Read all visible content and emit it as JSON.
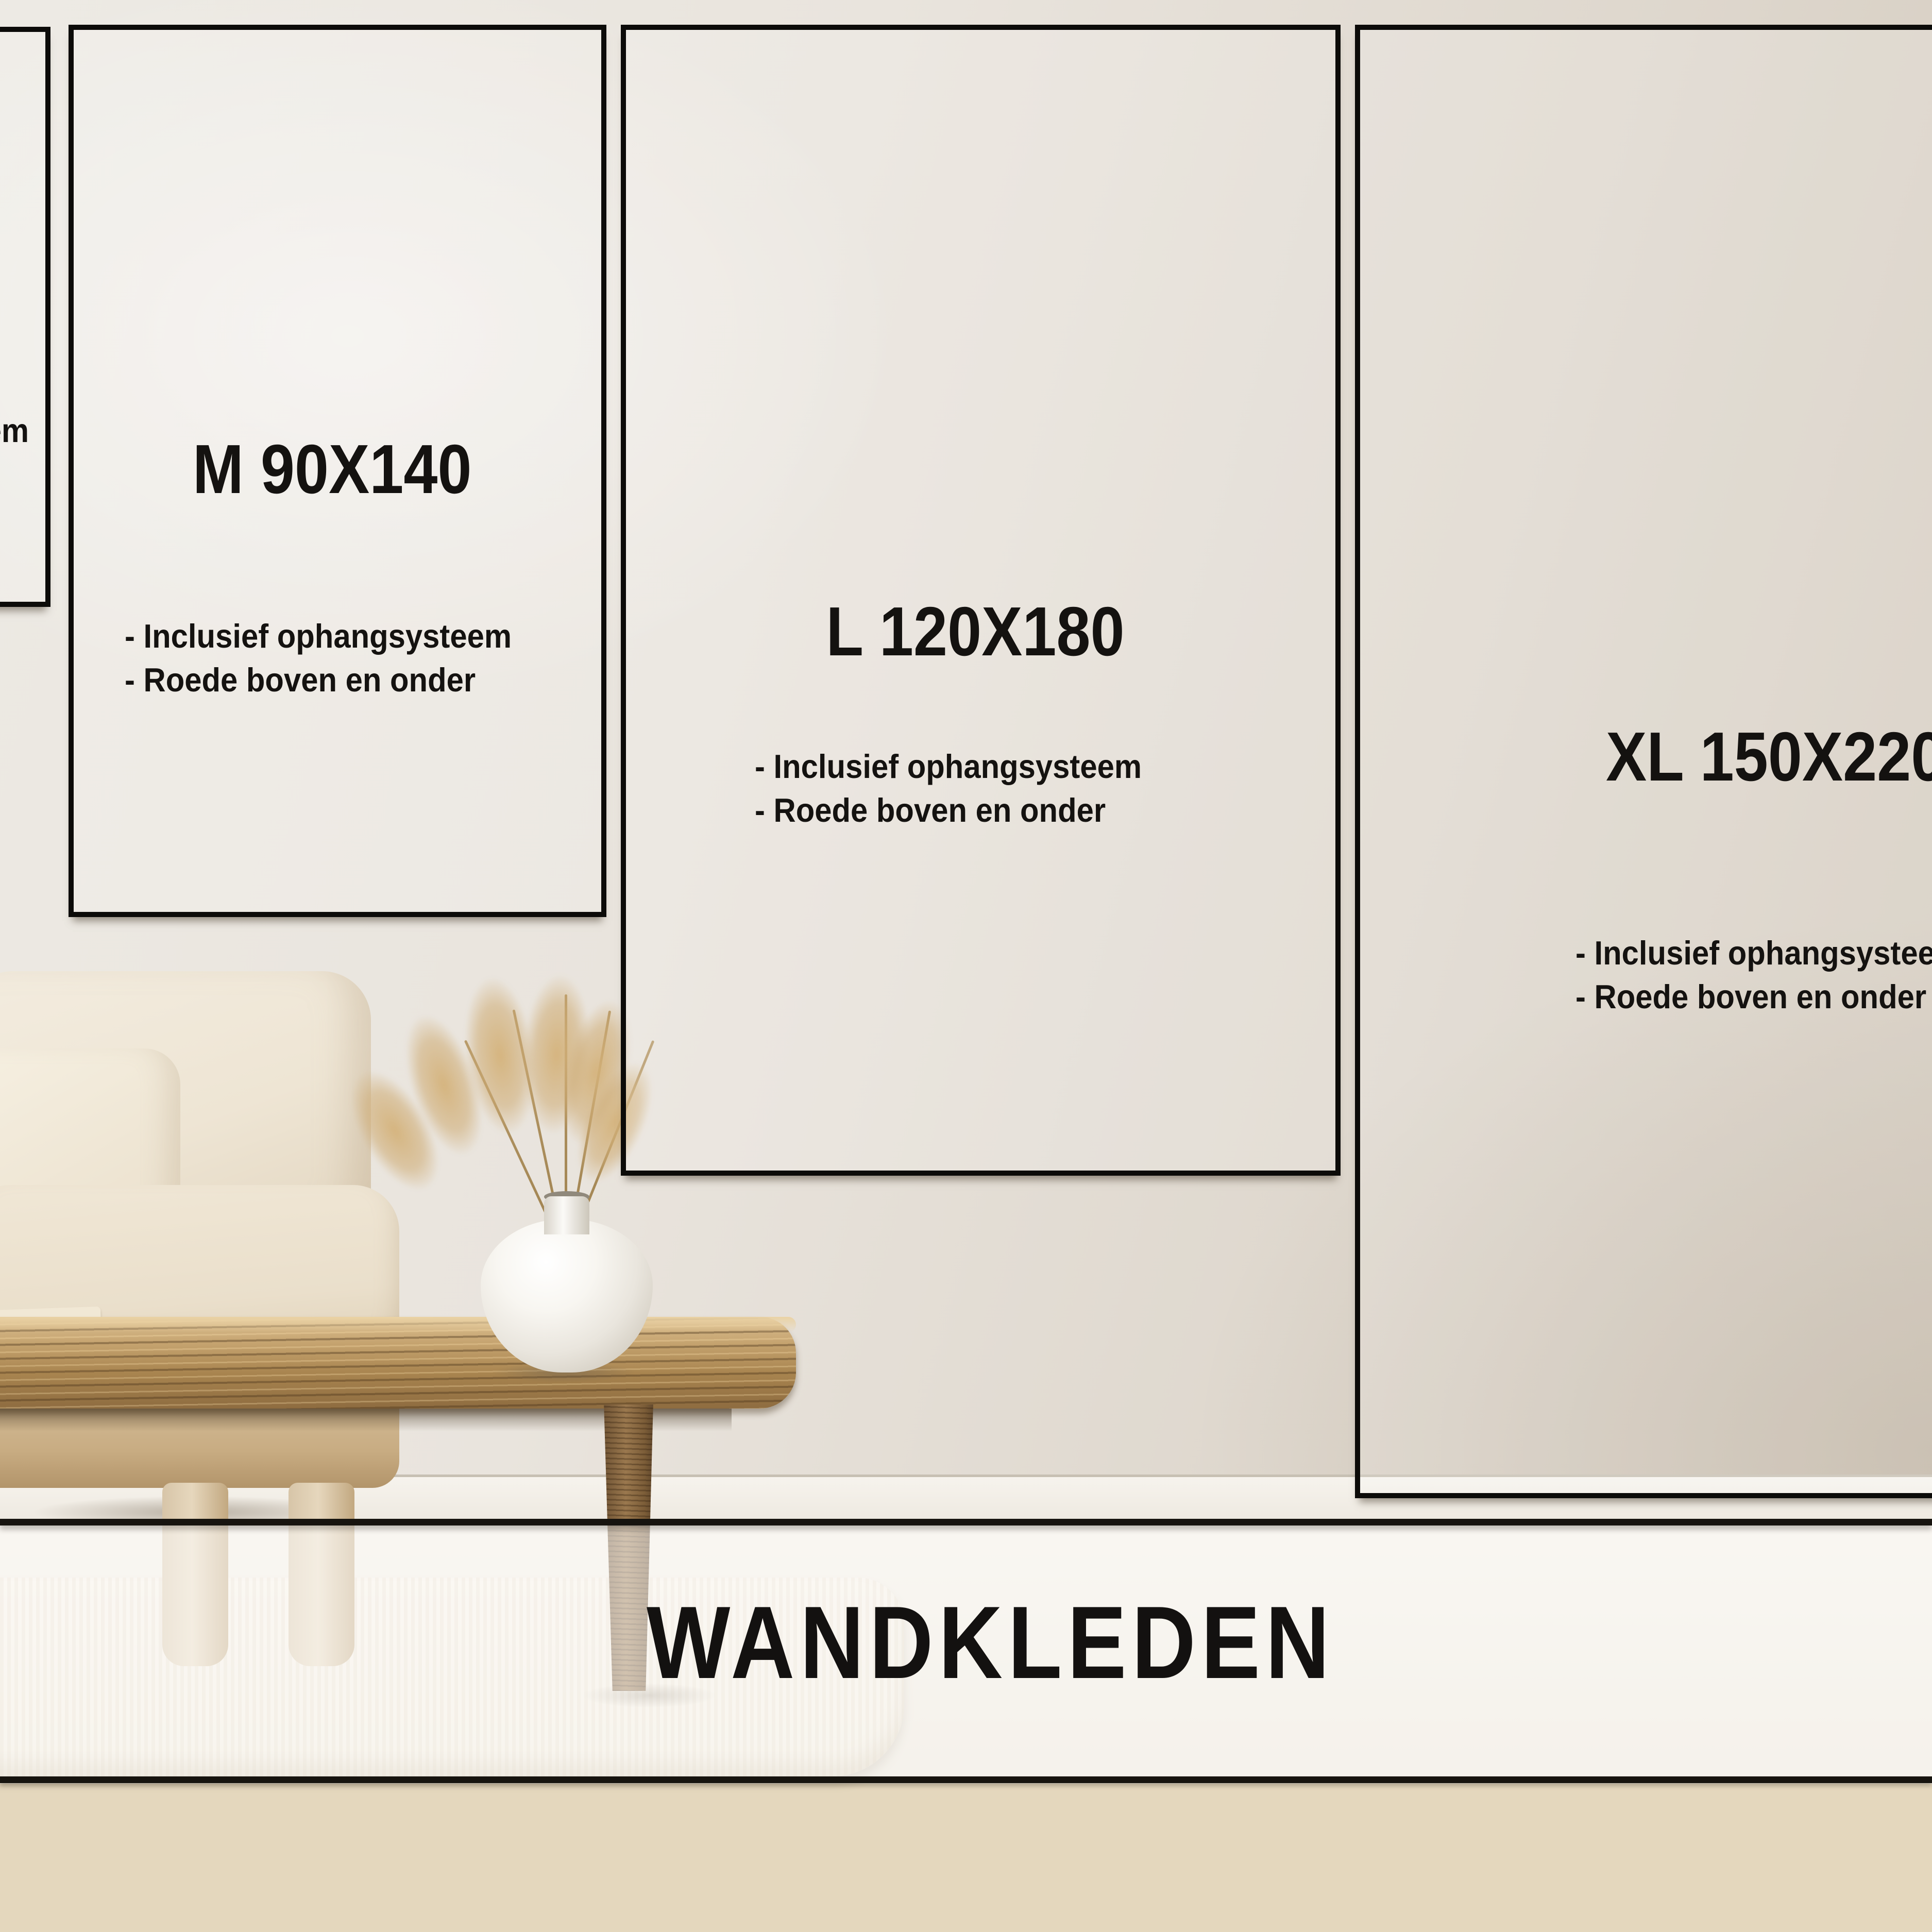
{
  "banner": {
    "title": "WANDKLEDEN"
  },
  "feature_lines": [
    "- Inclusief ophangsysteem",
    "- Roede boven en onder"
  ],
  "size_cards": [
    {
      "id": "s",
      "label": ""
    },
    {
      "id": "m",
      "label": "M 90X140"
    },
    {
      "id": "l",
      "label": "L 120X180"
    },
    {
      "id": "xl",
      "label": "XL 150X220"
    }
  ],
  "colors": {
    "ink": "#141210",
    "card_border": "#0c0b09",
    "wall_light": "#edeae4",
    "wall_dark": "#d3cabd",
    "overlay": "rgba(255,255,255,0.55)"
  }
}
